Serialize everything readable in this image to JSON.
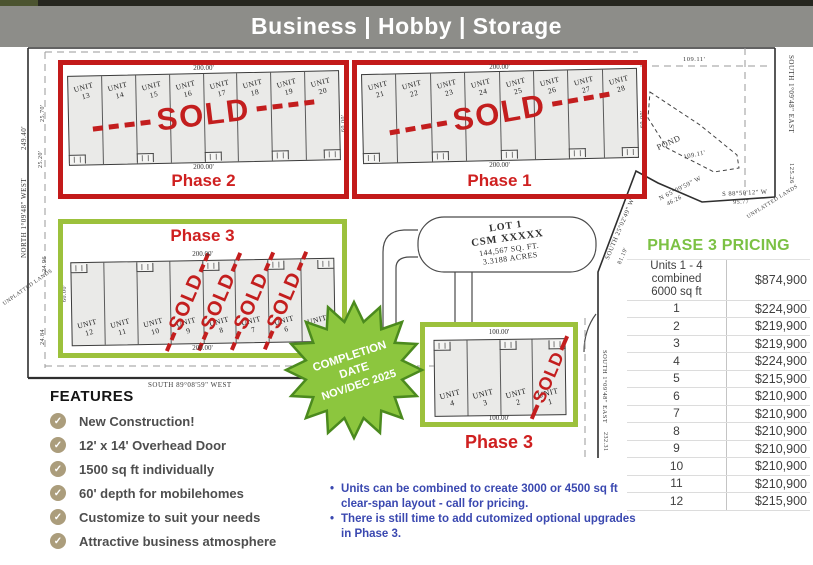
{
  "header": {
    "title": "Business | Hobby | Storage"
  },
  "phases": {
    "phase2": {
      "label": "Phase 2",
      "sold": "SOLD",
      "dim_top": "200.00'",
      "dim_bottom": "200.00'",
      "units": [
        "13",
        "14",
        "15",
        "16",
        "17",
        "18",
        "19",
        "20"
      ],
      "sold_units": []
    },
    "phase1": {
      "label": "Phase 1",
      "sold": "SOLD",
      "dim_top": "200.00'",
      "dim_bottom": "200.00'",
      "units": [
        "21",
        "22",
        "23",
        "24",
        "25",
        "26",
        "27",
        "28"
      ],
      "sold_units": []
    },
    "phase3_main": {
      "label": "Phase 3",
      "sold": "SOLD",
      "dim_top": "200.00'",
      "dim_bottom": "200.00'",
      "units": [
        "12",
        "11",
        "10",
        "9",
        "8",
        "7",
        "6",
        "5"
      ],
      "sold_units": [
        "9",
        "8",
        "7",
        "6"
      ]
    },
    "phase3_small": {
      "label": "Phase 3",
      "sold": "SOLD",
      "dim_top": "100.00'",
      "dim_bottom": "100.00'",
      "units": [
        "4",
        "3",
        "2",
        "1"
      ],
      "sold_units": [
        "1"
      ]
    }
  },
  "unit_word": "UNIT",
  "lot": {
    "line1": "LOT 1",
    "line2": "CSM XXXXX",
    "line3": "144,567 SQ. FT.",
    "line4": "3.3188 ACRES"
  },
  "starburst": {
    "line1": "COMPLETION",
    "line2": "DATE",
    "line3": "NOV/DEC 2025"
  },
  "pricing": {
    "title": "PHASE 3 PRICING",
    "rows": [
      {
        "label": "Units 1 - 4 combined",
        "label2": "6000 sq ft",
        "price": "$874,900"
      },
      {
        "label": "1",
        "price": "$224,900"
      },
      {
        "label": "2",
        "price": "$219,900"
      },
      {
        "label": "3",
        "price": "$219,900"
      },
      {
        "label": "4",
        "price": "$224,900"
      },
      {
        "label": "5",
        "price": "$215,900"
      },
      {
        "label": "6",
        "price": "$210,900"
      },
      {
        "label": "7",
        "price": "$210,900"
      },
      {
        "label": "8",
        "price": "$210,900"
      },
      {
        "label": "9",
        "price": "$210,900"
      },
      {
        "label": "10",
        "price": "$210,900"
      },
      {
        "label": "11",
        "price": "$210,900"
      },
      {
        "label": "12",
        "price": "$215,900"
      }
    ]
  },
  "features": {
    "title": "FEATURES",
    "items": [
      "New Construction!",
      "12' x 14' Overhead Door",
      "1500 sq ft individually",
      "60' depth for mobilehomes",
      "Customize to suit your needs",
      "Attractive business atmosphere"
    ]
  },
  "notes": {
    "items": [
      "Units can be combined to create 3000 or 4500 sq ft clear-span layout - call for pricing.",
      "There is still time to add cutomized optional upgrades in Phase 3."
    ]
  },
  "survey": {
    "labels": [
      "249.40'",
      "NORTH 1°09'48\" WEST",
      "25.70'",
      "25.20'",
      "24.96",
      "24.84",
      "UNPLATTED LANDS",
      "SOUTH 89°08'59\" WEST",
      "109.11'",
      "SOUTH 1°09'48\" EAST",
      "125.26",
      "POND",
      "109.11'",
      "N 65°09'59\" W",
      "46.26",
      "S 88°50'12\" W",
      "95.77",
      "SOUTH 25°02'49\" W",
      "81.19'",
      "SOUTH 1°09'48\" EAST",
      "232.31",
      "UNPLATTED LANDS",
      "60.00'",
      "60.00'",
      "60.00'"
    ]
  },
  "colors": {
    "header_bg": "#8d8d89",
    "red_box": "#c31a1a",
    "sold_red": "#c31e1e",
    "green_box": "#9cc13c",
    "star_fill": "#8cc63e",
    "star_stroke": "#4b8a1e",
    "pricing_green": "#7cc144",
    "notes_blue": "#3a48b0",
    "check_tan": "#ab9d7c"
  }
}
